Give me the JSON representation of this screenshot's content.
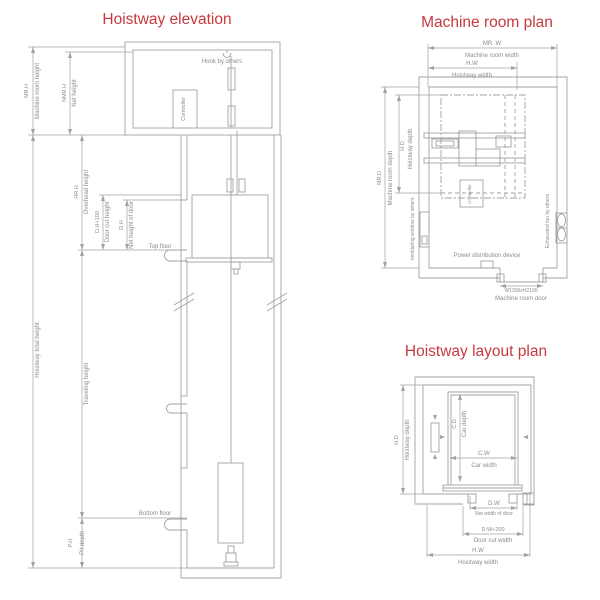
{
  "colors": {
    "title_red": "#c6393f",
    "line_gray": "#a2a2a2",
    "label_gray": "#8c8c8c"
  },
  "elevation": {
    "title": "Hoistway elevation",
    "dims": {
      "mrh_abbr": "MR.H",
      "mrh": "Machine room height",
      "nmrh_abbr": "NMR.H",
      "nmrh": "Net height",
      "hrh_abbr": "HR.H",
      "hrh": "Overhead height",
      "dh100_abbr": "D.H+100",
      "dh100": "Door cut height",
      "dh_abbr": "D.H",
      "dh": "Net height of door",
      "total": "Hoistway total height",
      "traveling": "Traveling height",
      "ph_abbr": "P.H",
      "ph": "Pit depth"
    },
    "notes": {
      "hook": "Hook by others",
      "controller": "Controller",
      "top_floor": "Top floor",
      "bottom_floor": "Bottom floor"
    }
  },
  "machine_room": {
    "title": "Machine room plan",
    "dims": {
      "mrw_abbr": "MR. W",
      "mrw": "Machine room width",
      "hw_abbr": "H.W",
      "hw": "Hoistway width",
      "mrd_abbr": "MR.D",
      "mrd": "Machine room depth",
      "hd_abbr": "H.D",
      "hd": "Hoistway depth",
      "door_size": "W1200xH2100"
    },
    "notes": {
      "ventilating": "Ventilating window by others",
      "controller": "Controller",
      "exhausted": "Exhausted fan by others",
      "power": "Power distribution device",
      "door": "Machine room door"
    }
  },
  "layout": {
    "title": "Hoistway layout plan",
    "dims": {
      "hd_abbr": "H.D",
      "hd": "Hoistway depth",
      "cd_abbr": "C.D",
      "cd": "Car depth",
      "cw_abbr": "C.W",
      "cw": "Car width",
      "dw_abbr": "D.W",
      "dw": "Net width of door",
      "dw200_abbr": "D.W+200",
      "dw200": "Door cut width",
      "hw_abbr": "H.W",
      "hw": "Hoistway width"
    }
  }
}
